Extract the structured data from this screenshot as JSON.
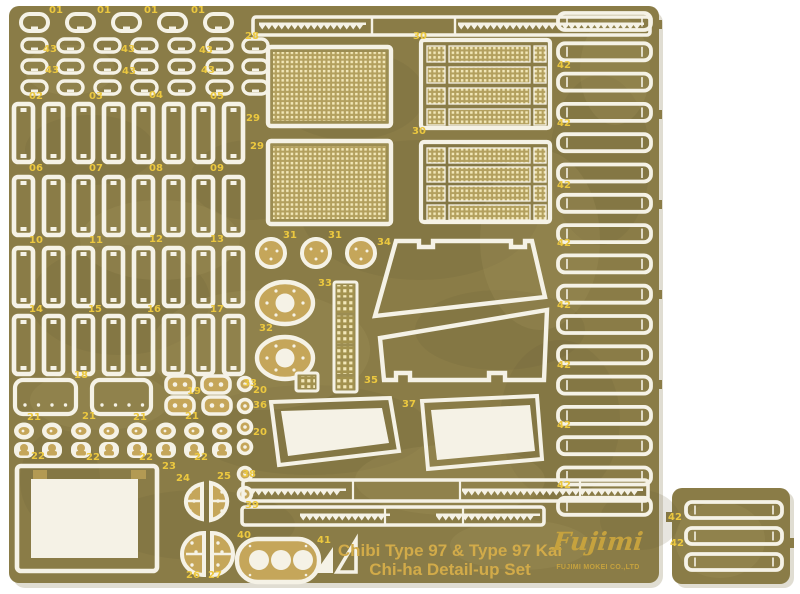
{
  "photo": {
    "background": "#ffffff",
    "sheet_base_color": "#8a7c47",
    "sheet_dark_blotch": "#6c5f35",
    "sheet_light_blotch": "#a79a5f",
    "cut_color": "#f5f2e6",
    "plate_color": "#c5a65a",
    "mesh_bg_color": "#b3a05e",
    "mesh_dot_color": "#f2e7b8",
    "label_color": "#ecc83f",
    "title_line1": "Chibi Type 97 & Type 97 Kai",
    "title_line2": "Chi-ha Detail-up Set",
    "title_color": "#d2ab49",
    "brand_script": "Fujimi",
    "brand_tagline": "FUJIMI MOKEI CO.,LTD",
    "brand_color": "#c6a23e",
    "part_labels": [
      {
        "t": "01",
        "x": 49,
        "y": 6
      },
      {
        "t": "01",
        "x": 97,
        "y": 6
      },
      {
        "t": "01",
        "x": 144,
        "y": 6
      },
      {
        "t": "01",
        "x": 191,
        "y": 6
      },
      {
        "t": "43",
        "x": 43,
        "y": 45
      },
      {
        "t": "43",
        "x": 121,
        "y": 45
      },
      {
        "t": "43",
        "x": 199,
        "y": 46
      },
      {
        "t": "43",
        "x": 45,
        "y": 66
      },
      {
        "t": "43",
        "x": 122,
        "y": 67
      },
      {
        "t": "43",
        "x": 201,
        "y": 66
      },
      {
        "t": "02",
        "x": 29,
        "y": 92
      },
      {
        "t": "03",
        "x": 89,
        "y": 92
      },
      {
        "t": "04",
        "x": 149,
        "y": 91
      },
      {
        "t": "05",
        "x": 210,
        "y": 92
      },
      {
        "t": "06",
        "x": 29,
        "y": 164
      },
      {
        "t": "07",
        "x": 89,
        "y": 164
      },
      {
        "t": "08",
        "x": 149,
        "y": 164
      },
      {
        "t": "09",
        "x": 210,
        "y": 164
      },
      {
        "t": "10",
        "x": 29,
        "y": 236
      },
      {
        "t": "11",
        "x": 89,
        "y": 236
      },
      {
        "t": "12",
        "x": 149,
        "y": 235
      },
      {
        "t": "13",
        "x": 210,
        "y": 235
      },
      {
        "t": "14",
        "x": 29,
        "y": 305
      },
      {
        "t": "15",
        "x": 88,
        "y": 305
      },
      {
        "t": "16",
        "x": 147,
        "y": 305
      },
      {
        "t": "17",
        "x": 210,
        "y": 305
      },
      {
        "t": "18",
        "x": 74,
        "y": 371
      },
      {
        "t": "19",
        "x": 187,
        "y": 387
      },
      {
        "t": "20",
        "x": 253,
        "y": 386
      },
      {
        "t": "20",
        "x": 253,
        "y": 428
      },
      {
        "t": "21",
        "x": 27,
        "y": 413
      },
      {
        "t": "21",
        "x": 82,
        "y": 412
      },
      {
        "t": "21",
        "x": 133,
        "y": 413
      },
      {
        "t": "21",
        "x": 185,
        "y": 412
      },
      {
        "t": "22",
        "x": 31,
        "y": 452
      },
      {
        "t": "22",
        "x": 86,
        "y": 453
      },
      {
        "t": "22",
        "x": 139,
        "y": 453
      },
      {
        "t": "22",
        "x": 194,
        "y": 453
      },
      {
        "t": "23",
        "x": 162,
        "y": 462
      },
      {
        "t": "24",
        "x": 176,
        "y": 474
      },
      {
        "t": "25",
        "x": 217,
        "y": 472
      },
      {
        "t": "26",
        "x": 186,
        "y": 571
      },
      {
        "t": "27",
        "x": 208,
        "y": 571
      },
      {
        "t": "28",
        "x": 245,
        "y": 32
      },
      {
        "t": "29",
        "x": 246,
        "y": 114
      },
      {
        "t": "29",
        "x": 250,
        "y": 142
      },
      {
        "t": "30",
        "x": 413,
        "y": 32
      },
      {
        "t": "30",
        "x": 412,
        "y": 127
      },
      {
        "t": "31",
        "x": 283,
        "y": 231
      },
      {
        "t": "31",
        "x": 328,
        "y": 231
      },
      {
        "t": "32",
        "x": 259,
        "y": 324
      },
      {
        "t": "33",
        "x": 318,
        "y": 279
      },
      {
        "t": "33",
        "x": 243,
        "y": 379
      },
      {
        "t": "34",
        "x": 377,
        "y": 238
      },
      {
        "t": "35",
        "x": 364,
        "y": 376
      },
      {
        "t": "36",
        "x": 253,
        "y": 401
      },
      {
        "t": "37",
        "x": 402,
        "y": 400
      },
      {
        "t": "38",
        "x": 242,
        "y": 470
      },
      {
        "t": "39",
        "x": 245,
        "y": 501
      },
      {
        "t": "40",
        "x": 237,
        "y": 531
      },
      {
        "t": "41",
        "x": 317,
        "y": 536
      },
      {
        "t": "42",
        "x": 557,
        "y": 61
      },
      {
        "t": "42",
        "x": 557,
        "y": 119
      },
      {
        "t": "42",
        "x": 557,
        "y": 181
      },
      {
        "t": "42",
        "x": 557,
        "y": 239
      },
      {
        "t": "42",
        "x": 557,
        "y": 301
      },
      {
        "t": "42",
        "x": 557,
        "y": 361
      },
      {
        "t": "42",
        "x": 557,
        "y": 421
      },
      {
        "t": "42",
        "x": 557,
        "y": 481
      },
      {
        "t": "42",
        "x": 668,
        "y": 513
      },
      {
        "t": "42",
        "x": 670,
        "y": 539
      }
    ]
  }
}
